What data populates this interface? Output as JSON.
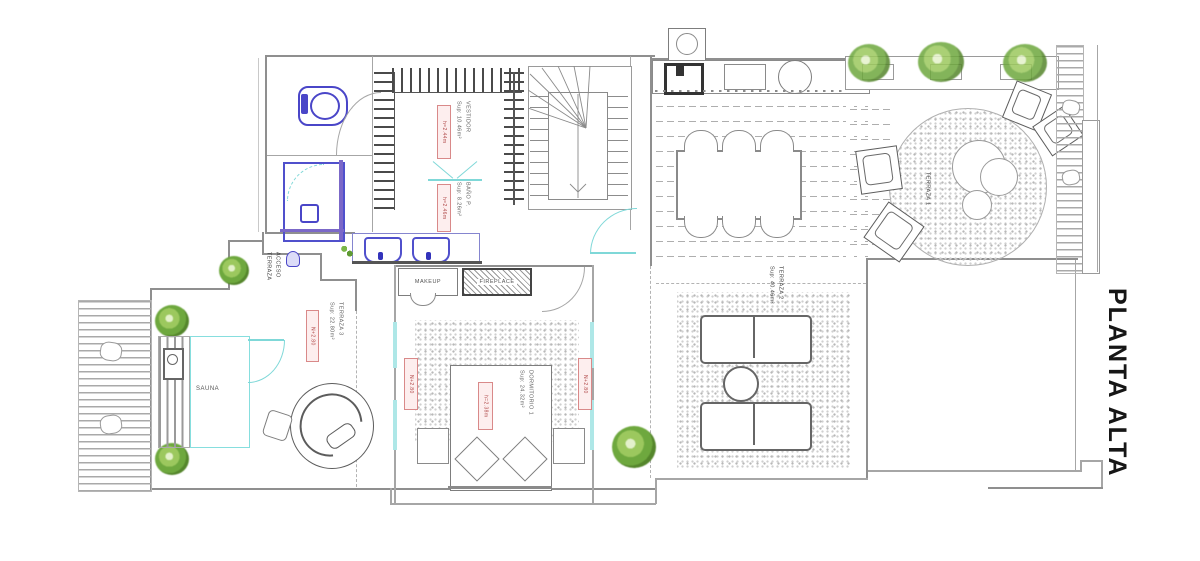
{
  "title": "PLANTA ALTA",
  "rooms": {
    "sauna": "SAUNA",
    "makeup": "MAKEUP",
    "fireplace": "FIREPLACE",
    "terraza1": "TERRAZA 1",
    "terraza2": "TERRAZA 2\nSup: 40.46m²",
    "terraza3": "TERRAZA 3\nSup: 22.80m²",
    "acceso": "ACCESO\nTERRAZA",
    "dormitorio": "DORMITORIO 1\nSup: 24.32m²",
    "vestidor": "VESTIDOR\nSup: 10.46m²",
    "bano": "BAÑO P.\nSup: 8.26m²"
  },
  "tags": {
    "closet_height": "h=2.44m",
    "bath_height": "h=2.46m",
    "lounge_level": "N+2.80",
    "bed_left_level": "N+2.80",
    "bed_right_level": "N+2.80",
    "bed_height": "h=2.38m"
  },
  "colors": {
    "wall": "#8f8f8f",
    "glass": "#7fd8d8",
    "plumbing": "#4a46c8",
    "shower": "#7b68c8",
    "plant": "#7ab648",
    "label_text": "#b04848"
  }
}
